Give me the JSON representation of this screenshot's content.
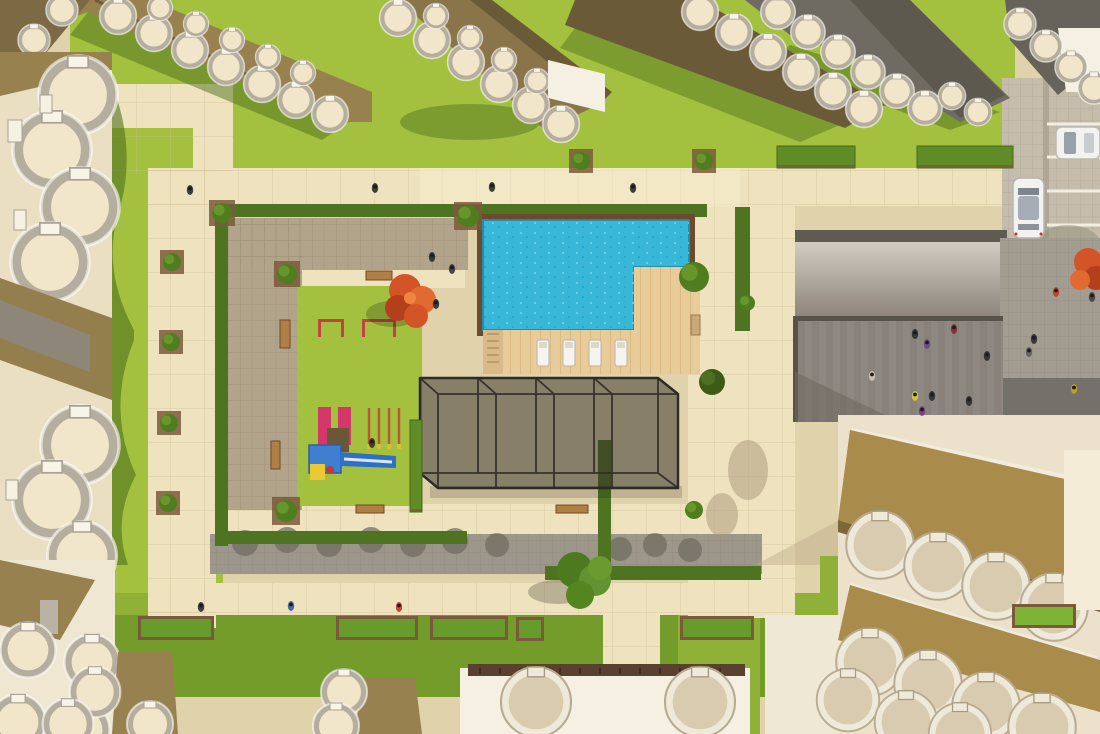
{
  "scene": {
    "title": "Aerial top-down 3D render of a residential complex central courtyard",
    "palette": {
      "base": "#e0d2ab",
      "path": "#efe3bf",
      "path_bright": "#f6ecca",
      "lawn": "#a3c13f",
      "lawn_dark": "#749c2a",
      "lawn_mid": "#8fb138",
      "taupe": "#b2a38b",
      "cobble": "#9d978b",
      "plaza": "#8d8881",
      "plaza_dark": "#74706a",
      "parking": "#c6bcab",
      "ramp_top": "#d2ccc2",
      "ramp_bottom": "#8a8279",
      "hedge": "#4e7321",
      "shrub": "#679b2b",
      "tree_green": "#4f7d20",
      "tree_orange": "#d35426",
      "pool": "#38b7d8",
      "pool_border": "#6b4a2e",
      "deck": "#e8cb97",
      "glass": "rgba(48,44,38,0.5)",
      "frame": "#2e2b27",
      "cream": "#f1e6ca",
      "stone": "#d9cbb0",
      "scallop_rim": "#b5ad9d",
      "khaki": "#97824f",
      "khaki_gold": "#a98c4b",
      "khaki_dark": "#6b5a38",
      "roof_dark": "#6f6b62",
      "white_wall": "#f5f0e2",
      "car": "#f2f2f0",
      "shadow_green": "#4e6f1c",
      "play_red": "#d4386a",
      "play_blue": "#3f7fd0",
      "play_yellow": "#ecc832",
      "bar_red": "#c04540"
    },
    "objects": {
      "swimming_pool": {
        "shape": "L-shaped",
        "count": 1
      },
      "sun_loungers": {
        "count": 4
      },
      "glass_pavilion": {
        "bays": 4
      },
      "playground": {
        "red_slides": 2,
        "swing_posts": 4,
        "exercise_bars": 2,
        "blue_slide": 1
      },
      "benches": {
        "count": 5
      },
      "hedge_planter_boxes": {
        "count": 6
      },
      "hedgerows": {
        "count": 3
      },
      "cars": {
        "count": 2,
        "color": "white"
      },
      "parking_stripes": {
        "count": 5
      },
      "pedestrians": {
        "count": 25
      },
      "trees": {
        "orange": 2,
        "green_large": 2,
        "round_bushes": 12
      },
      "buildings": {
        "style": "scalloped curved balconies",
        "clusters": 7
      }
    },
    "sprites": {
      "people": [
        {
          "x": 190,
          "y": 190,
          "c": "#2f2f2f"
        },
        {
          "x": 375,
          "y": 188,
          "c": "#2f2f2f"
        },
        {
          "x": 492,
          "y": 187,
          "c": "#2f2f2f"
        },
        {
          "x": 633,
          "y": 188,
          "c": "#2f2f2f"
        },
        {
          "x": 432,
          "y": 257,
          "c": "#2f2f2f"
        },
        {
          "x": 452,
          "y": 269,
          "c": "#3b3b3b"
        },
        {
          "x": 436,
          "y": 304,
          "c": "#2f2f2f"
        },
        {
          "x": 372,
          "y": 443,
          "c": "#403328"
        },
        {
          "x": 201,
          "y": 607,
          "c": "#2f2f2f"
        },
        {
          "x": 291,
          "y": 606,
          "c": "#3a5fa0"
        },
        {
          "x": 399,
          "y": 607,
          "c": "#c0392b"
        },
        {
          "x": 915,
          "y": 334,
          "c": "#2f2f2f"
        },
        {
          "x": 927,
          "y": 344,
          "c": "#6a4a8a"
        },
        {
          "x": 954,
          "y": 329,
          "c": "#8a2a3a"
        },
        {
          "x": 987,
          "y": 356,
          "c": "#2f2f2f"
        },
        {
          "x": 872,
          "y": 376,
          "c": "#cfc6b4"
        },
        {
          "x": 915,
          "y": 396,
          "c": "#d8c838"
        },
        {
          "x": 932,
          "y": 396,
          "c": "#2f2f2f"
        },
        {
          "x": 922,
          "y": 411,
          "c": "#7a3a8a"
        },
        {
          "x": 969,
          "y": 401,
          "c": "#2f2f2f"
        },
        {
          "x": 1034,
          "y": 339,
          "c": "#2f2f2f"
        },
        {
          "x": 1029,
          "y": 352,
          "c": "#5e5e5e"
        },
        {
          "x": 1074,
          "y": 389,
          "c": "#c8a020"
        },
        {
          "x": 1092,
          "y": 297,
          "c": "#444444"
        },
        {
          "x": 1056,
          "y": 292,
          "c": "#c04028"
        }
      ],
      "bushes": [
        {
          "x": 172,
          "y": 262,
          "r": 9,
          "sq": 1
        },
        {
          "x": 171,
          "y": 342,
          "r": 9,
          "sq": 1
        },
        {
          "x": 169,
          "y": 423,
          "r": 9,
          "sq": 1
        },
        {
          "x": 168,
          "y": 503,
          "r": 9,
          "sq": 1
        },
        {
          "x": 222,
          "y": 213,
          "r": 10,
          "sq": 1
        },
        {
          "x": 287,
          "y": 274,
          "r": 10,
          "sq": 1
        },
        {
          "x": 468,
          "y": 216,
          "r": 11,
          "sq": 1
        },
        {
          "x": 694,
          "y": 277,
          "r": 15
        },
        {
          "x": 286,
          "y": 511,
          "r": 11,
          "sq": 1
        },
        {
          "x": 694,
          "y": 510,
          "r": 9
        },
        {
          "x": 581,
          "y": 161,
          "r": 9,
          "sq": 1
        },
        {
          "x": 704,
          "y": 161,
          "r": 9,
          "sq": 1
        },
        {
          "x": 712,
          "y": 382,
          "r": 13,
          "dark": 1
        },
        {
          "x": 747,
          "y": 303,
          "r": 8
        }
      ],
      "loungers": {
        "xs": [
          537,
          563,
          589,
          615
        ],
        "y": 340
      },
      "parking_stripes": {
        "ys": [
          124,
          157,
          191,
          225,
          259
        ],
        "x1": 1047,
        "x2": 1100
      },
      "planters": [
        {
          "x": 138,
          "y": 616,
          "w": 76
        },
        {
          "x": 336,
          "y": 616,
          "w": 82
        },
        {
          "x": 430,
          "y": 616,
          "w": 78
        },
        {
          "x": 516,
          "y": 617,
          "w": 28
        },
        {
          "x": 680,
          "y": 616,
          "w": 74
        },
        {
          "x": 1012,
          "y": 604,
          "w": 64,
          "f": "#7fb335"
        }
      ],
      "hedgerows": [
        {
          "x": 777,
          "y": 146,
          "w": 78,
          "h": 22
        },
        {
          "x": 917,
          "y": 146,
          "w": 96,
          "h": 22
        },
        {
          "x": 410,
          "y": 420,
          "w": 12,
          "h": 92
        }
      ]
    }
  }
}
